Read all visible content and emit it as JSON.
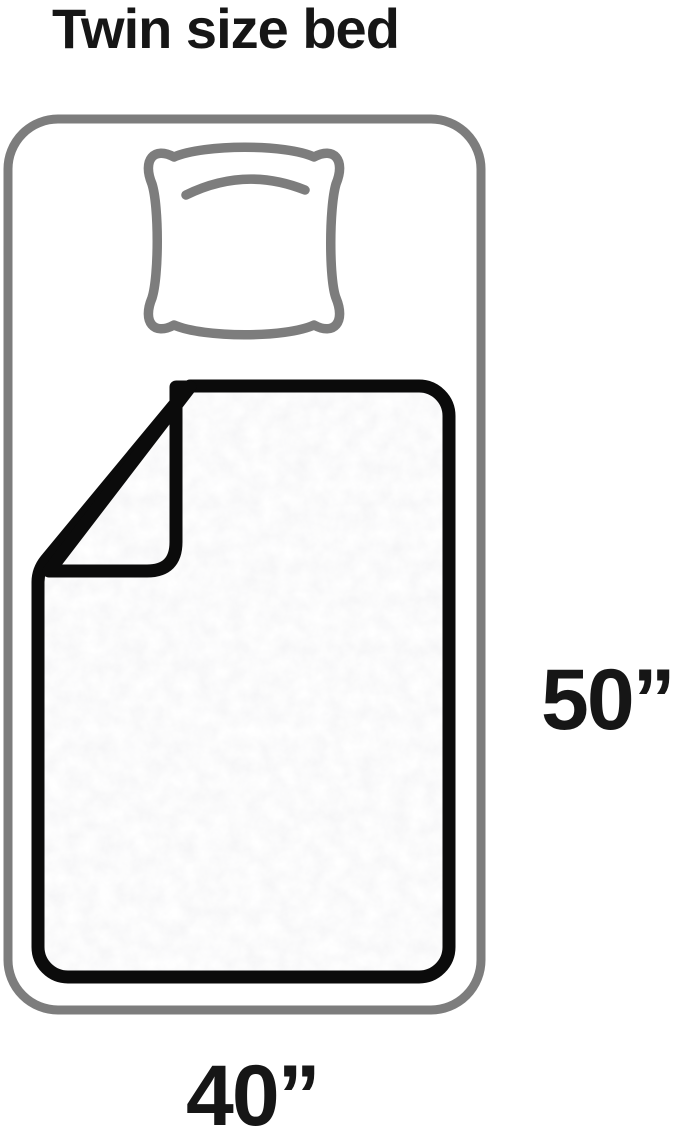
{
  "title": "Twin size bed",
  "diagram": {
    "bed": "twin size bed outline",
    "items": "pillow, blanket",
    "height_label": "50”",
    "width_label": "40”",
    "height_in": 50,
    "width_in": 40
  },
  "colors": {
    "outline": "#7d7d7d",
    "ink": "#0b0b0b",
    "text": "#161616",
    "bg": "#ffffff"
  }
}
